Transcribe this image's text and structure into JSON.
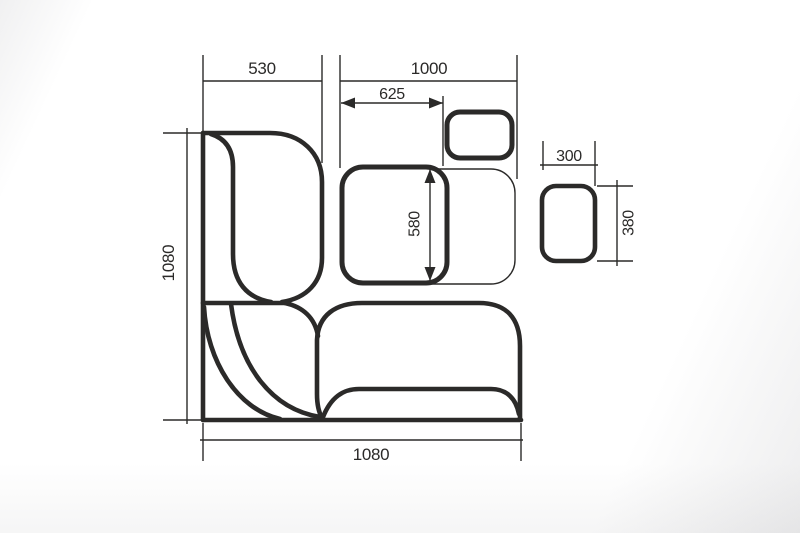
{
  "drawing": {
    "description": "plan-view dimension drawing of a corner bench dinette set with table and stools",
    "line_color": "#2b2a29",
    "background_color": "#ffffff",
    "dimensions": {
      "left_bench_width": "530",
      "table_zone_width": "1000",
      "table_width": "625",
      "table_depth": "580",
      "left_side_depth": "1080",
      "bottom_side_length": "1080",
      "stool_width": "300",
      "stool_depth": "380"
    }
  }
}
